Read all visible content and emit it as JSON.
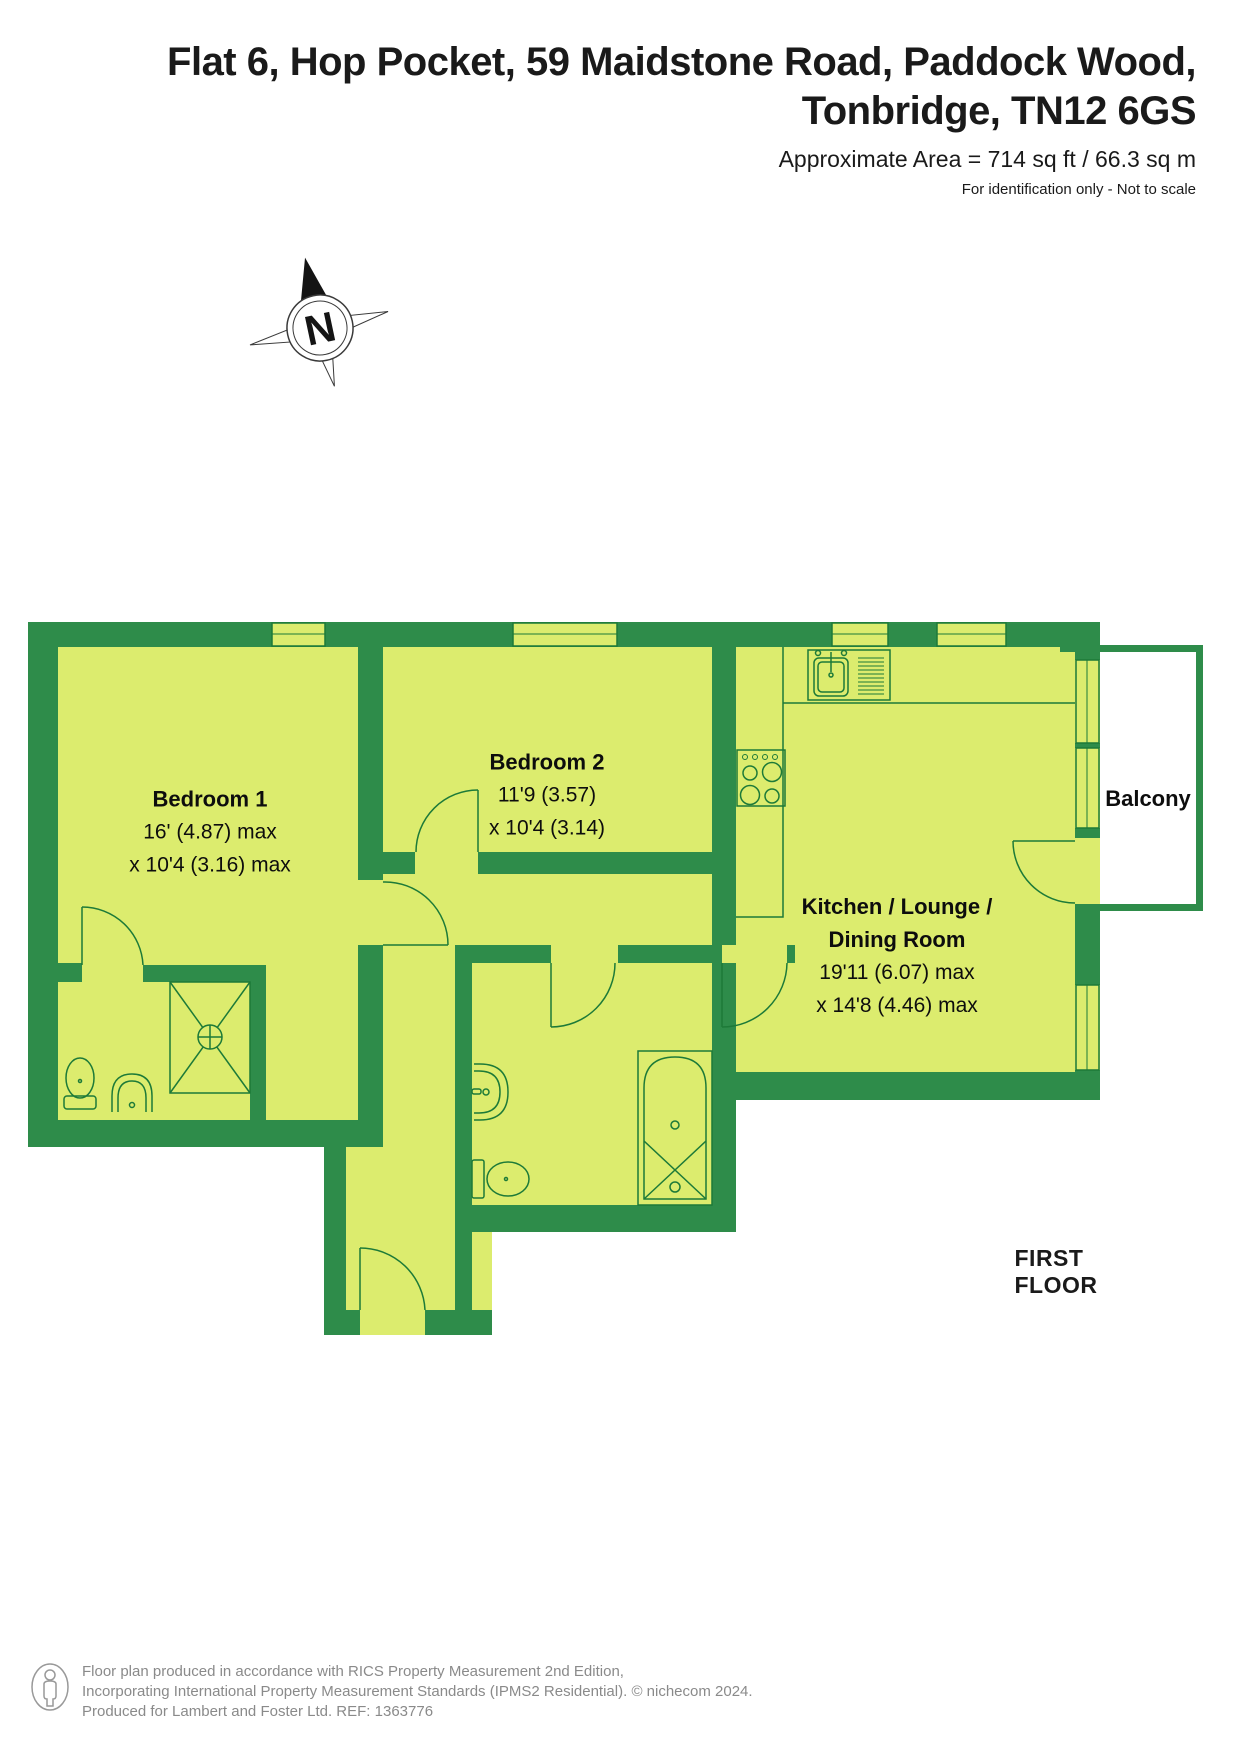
{
  "header": {
    "title_line1": "Flat 6, Hop Pocket, 59 Maidstone Road, Paddock Wood,",
    "title_line2": "Tonbridge, TN12 6GS",
    "area": "Approximate Area = 714 sq ft / 66.3 sq m",
    "disclaimer": "For identification only - Not to scale"
  },
  "compass": {
    "label": "N"
  },
  "floorplan": {
    "floor_label": "FIRST FLOOR",
    "rooms": [
      {
        "id": "bedroom1",
        "name": "Bedroom 1",
        "dim1": "16' (4.87) max",
        "dim2": "x 10'4 (3.16) max"
      },
      {
        "id": "bedroom2",
        "name": "Bedroom 2",
        "dim1": "11'9 (3.57)",
        "dim2": "x 10'4 (3.14)"
      },
      {
        "id": "kitchen",
        "name_line1": "Kitchen / Lounge /",
        "name_line2": "Dining Room",
        "dim1": "19'11 (6.07) max",
        "dim2": "x 14'8 (4.46) max"
      },
      {
        "id": "balcony",
        "name": "Balcony"
      }
    ]
  },
  "colors": {
    "wall_green": "#2e8c4a",
    "room_fill": "#dcec6e",
    "fixture_line": "#1d7a38",
    "text": "#111111",
    "footer_gray": "#8a8a8a"
  },
  "footer": {
    "line1": "Floor plan produced in accordance with RICS Property Measurement 2nd Edition,",
    "line2": "Incorporating International Property Measurement Standards (IPMS2 Residential).  © nichecom 2024.",
    "line3": "Produced for Lambert and Foster Ltd.   REF:  1363776"
  }
}
